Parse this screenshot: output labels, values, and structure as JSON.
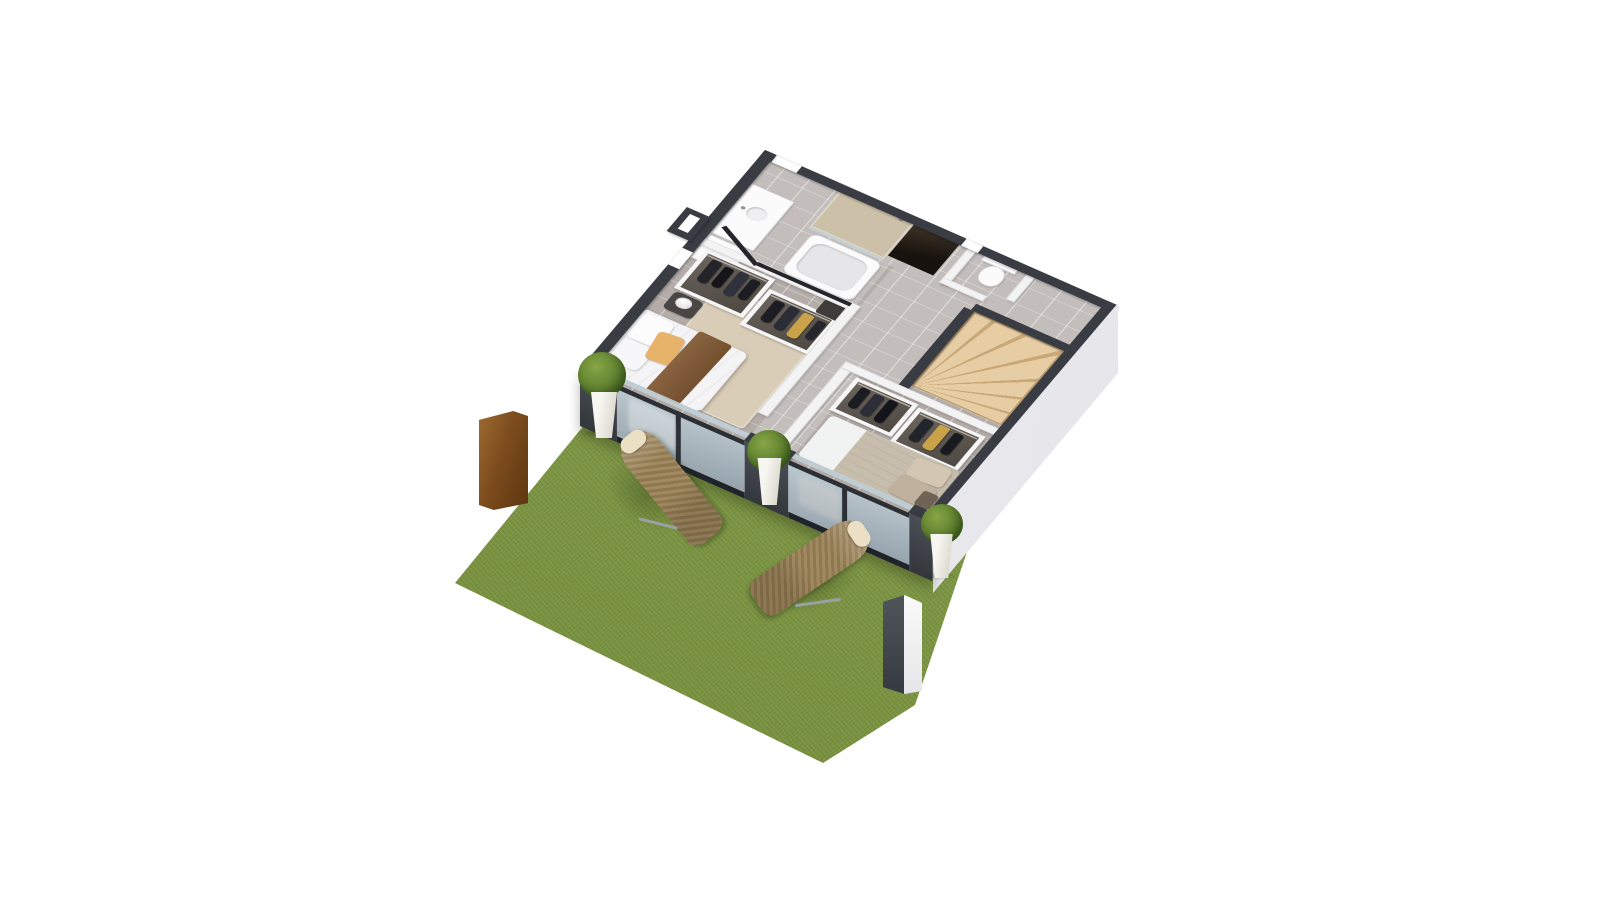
{
  "scene": {
    "description": "3D isometric cutaway floor-plan rendering of an upper floor with two bedrooms, bathroom, WC, wooden winder staircase and a garden terrace with lawn, sun loungers and planters",
    "background": "#ffffff",
    "visible_text": "none"
  },
  "palette": {
    "grass": "#819c41",
    "grass_dark": "#6d8834",
    "wall_dark": "#393d43",
    "wall_white": "#f3f3f4",
    "tile": "#b3aca8",
    "wood": "#ddc096",
    "wood_step": "#c9a877",
    "beige_wall": "#cdc0a8",
    "rug": "#d9cdb8",
    "duvet_white": "#f4f4f6",
    "pillow_orange": "#e7b269",
    "throw_brown": "#7f5937",
    "duvet_taupe": "#c7bdac",
    "pillow_beige": "#d3c7b4",
    "sheet_white": "#f1f3f3",
    "lounger": "#a18a63",
    "lounger_weave": "#8f774e",
    "cushion": "#ebe0c4",
    "corten": "#7c4c1d",
    "planter": "#f6f5ef",
    "shrub": "#5d7e2e",
    "glass": "#aabcc5",
    "frame_dark": "#2c3036",
    "pillar_dark": "#41464c",
    "exterior_white": "#ededf0",
    "door_dark": "#1d1712",
    "clothes_gold": "#c9a24a"
  },
  "house": {
    "view": "isometric-cutaway-3d",
    "rooms": [
      {
        "id": "bathroom",
        "items": [
          "vanity-sink",
          "storage-cabinet",
          "bathtub",
          "walk-in-shower-beige-tile"
        ]
      },
      {
        "id": "wc",
        "items": [
          "toilet"
        ]
      },
      {
        "id": "hallway",
        "items": [
          "dark-entry-doorway",
          "tiled-floor"
        ]
      },
      {
        "id": "staircase",
        "items": [
          "wooden-winder-stairs"
        ]
      },
      {
        "id": "bedroom-1",
        "items": [
          "double-bed-white-duvet",
          "orange-accent-pillow",
          "brown-throw",
          "wardrobe-with-clothes",
          "wardrobe-with-clothes",
          "bedside-table",
          "sphere-lamp",
          "beige-area-rug",
          "sliding-glass-door"
        ]
      },
      {
        "id": "bedroom-2",
        "items": [
          "double-bed-taupe-duvet",
          "beige-pillows",
          "wardrobe-with-clothes",
          "wardrobe-with-clothes",
          "sliding-glass-door"
        ]
      }
    ]
  },
  "garden": {
    "items": [
      "green-lawn",
      "wicker-sun-lounger",
      "wicker-chaise-lounger",
      "boxwood-planter",
      "boxwood-planter",
      "boxwood-planter",
      "corten-steel-panel",
      "exterior-pillar-white-dark"
    ]
  }
}
